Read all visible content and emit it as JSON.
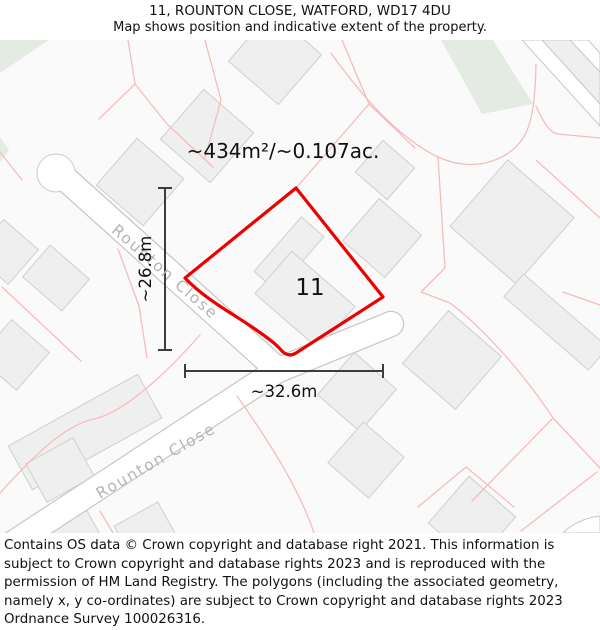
{
  "header": {
    "title": "11, ROUNTON CLOSE, WATFORD, WD17 4DU",
    "subtitle": "Map shows position and indicative extent of the property."
  },
  "map": {
    "area_label": "~434m²/~0.107ac.",
    "plot_number": "11",
    "width_label": "~32.6m",
    "height_label": "~26.8m",
    "street_label_1": "Rounton Close",
    "street_label_2": "Rounton Close",
    "colors": {
      "map_bg": "#fafafa",
      "plot_outline": "#ec0000",
      "parcel_line": "#f6bcbc",
      "building_fill": "#efefef",
      "building_stroke": "#cfcfcf",
      "road_fill": "#ffffff",
      "road_stroke": "#c8c8c8",
      "green_fill": "#e3ebe2",
      "street_label": "#b4b4b4",
      "dimension": "#3c3c3c"
    }
  },
  "footer": {
    "copyright": "Contains OS data © Crown copyright and database right 2021. This information is subject to Crown copyright and database rights 2023 and is reproduced with the permission of HM Land Registry. The polygons (including the associated geometry, namely x, y co-ordinates) are subject to Crown copyright and database rights 2023 Ordnance Survey 100026316."
  }
}
